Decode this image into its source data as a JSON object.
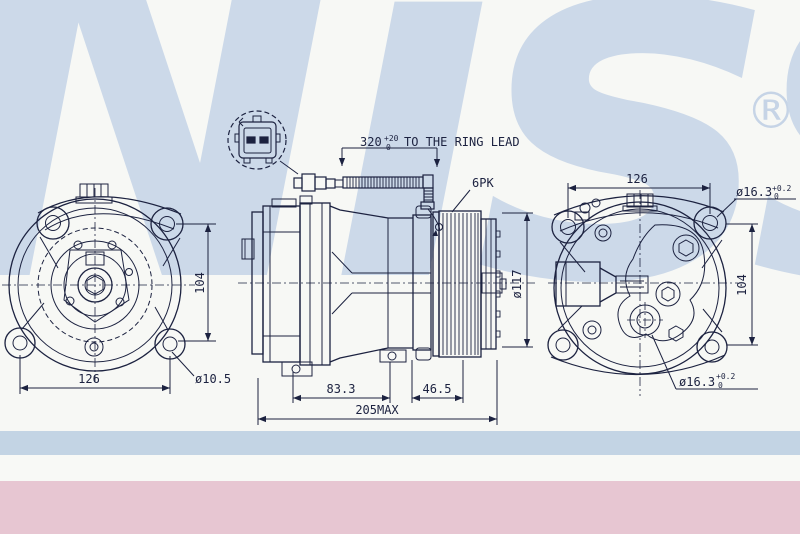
{
  "watermark": {
    "text": "Nissens",
    "mark": "®",
    "color": "#ccd9e9"
  },
  "colors": {
    "background": "#f7f8f5",
    "line": "#1c2240",
    "band_blue": "#c3d4e4",
    "band_white": "#f8f9f6",
    "band_pink": "#e7c6d2"
  },
  "drawing": {
    "harness": {
      "value": "320",
      "tol_plus": "+20",
      "tol_minus": "0",
      "note": "TO THE RING LEAD"
    },
    "belt": "6PK",
    "pulley_diameter": "ø117",
    "front_view": {
      "width": "126",
      "height": "104",
      "hole": "ø10.5"
    },
    "lengths": {
      "a": "83.3",
      "b": "46.5",
      "total": "205MAX"
    },
    "rear_view": {
      "width": "126",
      "height": "104",
      "hole_top": {
        "value": "ø16.3",
        "tol_plus": "+0.2",
        "tol_minus": "0"
      },
      "hole_bottom": {
        "value": "ø16.3",
        "tol_plus": "+0.2",
        "tol_minus": "0"
      }
    }
  }
}
